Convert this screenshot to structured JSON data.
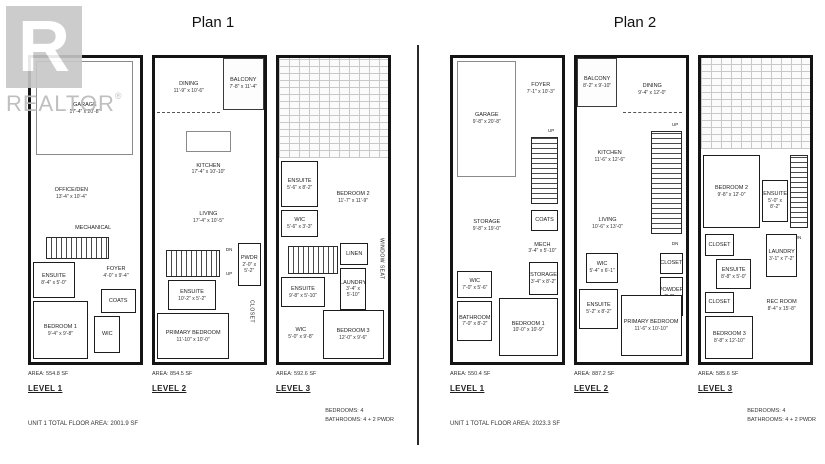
{
  "watermark": {
    "brand": "REALTOR",
    "registered": "®",
    "logo_letter": "R"
  },
  "plan1": {
    "title": "Plan 1",
    "total": "UNIT 1 TOTAL FLOOR AREA: 2001.9 SF",
    "bedrooms": "BEDROOMS: 4",
    "bathrooms": "BATHROOMS: 4 + 2 PWDR",
    "levels": [
      {
        "label": "LEVEL 1",
        "area": "AREA: 554.8 SF",
        "rooms": [
          {
            "type": "inner",
            "name": "GARAGE",
            "dims": "17'-4\" x 20'-8\"",
            "x": 5,
            "y": 1,
            "w": 89,
            "h": 31
          },
          {
            "type": "open",
            "name": "OFFICE/DEN",
            "dims": "13'-4\" x 10'-4\"",
            "x": 2,
            "y": 37,
            "w": 70,
            "h": 15
          },
          {
            "type": "open",
            "name": "MECHANICAL",
            "x": 26,
            "y": 53,
            "w": 62,
            "h": 6
          },
          {
            "type": "stairs-h",
            "x": 14,
            "y": 59,
            "w": 58,
            "h": 7
          },
          {
            "type": "open",
            "name": "FOYER",
            "dims": "4'-0\" x 9'-4\"",
            "x": 60,
            "y": 66,
            "w": 36,
            "h": 9
          },
          {
            "type": "room",
            "name": "ENSUITE",
            "dims": "8'-4\" x 5'-0\"",
            "x": 2,
            "y": 67,
            "w": 38,
            "h": 12
          },
          {
            "type": "room",
            "name": "COATS",
            "x": 64,
            "y": 76,
            "w": 32,
            "h": 8
          },
          {
            "type": "room",
            "name": "WIC",
            "x": 58,
            "y": 85,
            "w": 24,
            "h": 12
          },
          {
            "type": "room",
            "name": "BEDROOM 1",
            "dims": "9'-4\" x 9'-8\"",
            "x": 2,
            "y": 80,
            "w": 50,
            "h": 19
          }
        ]
      },
      {
        "label": "LEVEL 2",
        "area": "AREA: 854.5 SF",
        "rooms": [
          {
            "type": "balcony",
            "name": "BALCONY",
            "dims": "7'-8\" x 11'-4\"",
            "x": 62,
            "y": 0,
            "w": 38,
            "h": 17
          },
          {
            "type": "open-dash",
            "name": "DINING",
            "dims": "11'-9\" x 10'-6\"",
            "x": 2,
            "y": 2,
            "w": 58,
            "h": 16
          },
          {
            "type": "inner",
            "x": 28,
            "y": 24,
            "w": 42,
            "h": 7
          },
          {
            "type": "open",
            "name": "KITCHEN",
            "dims": "17'-4\" x 10'-10\"",
            "x": 4,
            "y": 31,
            "w": 90,
            "h": 11
          },
          {
            "type": "open",
            "name": "LIVING",
            "dims": "17'-4\" x 10'-5\"",
            "x": 4,
            "y": 45,
            "w": 90,
            "h": 15
          },
          {
            "type": "tag",
            "name": "DN",
            "x": 62,
            "y": 61,
            "w": 12,
            "h": 4
          },
          {
            "type": "stairs-h",
            "x": 10,
            "y": 63,
            "w": 50,
            "h": 9
          },
          {
            "type": "tag",
            "name": "UP",
            "x": 62,
            "y": 69,
            "w": 12,
            "h": 4
          },
          {
            "type": "room",
            "name": "PWDR",
            "dims": "2'-0\" x 5'-2\"",
            "x": 76,
            "y": 61,
            "w": 21,
            "h": 14
          },
          {
            "type": "room",
            "name": "ENSUITE",
            "dims": "10'-2\" x 5'-2\"",
            "x": 12,
            "y": 73,
            "w": 44,
            "h": 10
          },
          {
            "type": "vlabel",
            "name": "CLOSET",
            "x": 80,
            "y": 77,
            "w": 17,
            "h": 13
          },
          {
            "type": "room",
            "name": "PRIMARY BEDROOM",
            "dims": "11'-10\" x 10'-0\"",
            "x": 2,
            "y": 84,
            "w": 66,
            "h": 15
          }
        ]
      },
      {
        "label": "LEVEL 3",
        "area": "AREA: 592.6 SF",
        "rooms": [
          {
            "type": "hatch",
            "x": 0,
            "y": 0,
            "w": 100,
            "h": 33
          },
          {
            "type": "room",
            "name": "ENSUITE",
            "dims": "5'-6\" x 8'-2\"",
            "x": 2,
            "y": 34,
            "w": 34,
            "h": 15
          },
          {
            "type": "open",
            "name": "BEDROOM 2",
            "dims": "11'-7\" x 11'-9\"",
            "x": 40,
            "y": 37,
            "w": 56,
            "h": 18
          },
          {
            "type": "room",
            "name": "WIC",
            "dims": "5'-6\" x 3'-3\"",
            "x": 2,
            "y": 50,
            "w": 34,
            "h": 9
          },
          {
            "type": "stairs-h",
            "x": 8,
            "y": 62,
            "w": 46,
            "h": 9
          },
          {
            "type": "room",
            "name": "LINEN",
            "x": 56,
            "y": 61,
            "w": 26,
            "h": 7
          },
          {
            "type": "vlabel",
            "name": "WINDOW SEAT",
            "x": 89,
            "y": 52,
            "w": 10,
            "h": 28
          },
          {
            "type": "room",
            "name": "ENSUITE",
            "dims": "9'-8\" x 5'-10\"",
            "x": 2,
            "y": 72,
            "w": 40,
            "h": 10
          },
          {
            "type": "room",
            "name": "LAUNDRY",
            "dims": "3'-4\" x 5'-10\"",
            "x": 56,
            "y": 69,
            "w": 24,
            "h": 14
          },
          {
            "type": "open",
            "name": "WIC",
            "dims": "5'-0\" x 9'-8\"",
            "x": 4,
            "y": 84,
            "w": 32,
            "h": 13
          },
          {
            "type": "room",
            "name": "BEDROOM 3",
            "dims": "12'-0\" x 9'-6\"",
            "x": 40,
            "y": 83,
            "w": 56,
            "h": 16
          }
        ]
      }
    ]
  },
  "plan2": {
    "title": "Plan 2",
    "total": "UNIT 1 TOTAL FLOOR AREA: 2023.3 SF",
    "bedrooms": "BEDROOMS: 4",
    "bathrooms": "BATHROOMS: 4 + 2 PWDR",
    "levels": [
      {
        "label": "LEVEL 1",
        "area": "AREA: 550.4 SF",
        "rooms": [
          {
            "type": "inner",
            "name": "GARAGE",
            "dims": "9'-8\" x 20'-8\"",
            "x": 4,
            "y": 1,
            "w": 54,
            "h": 38
          },
          {
            "type": "open",
            "name": "FOYER",
            "dims": "7'-1\" x 10'-3\"",
            "x": 64,
            "y": 4,
            "w": 33,
            "h": 12
          },
          {
            "type": "tag",
            "name": "UP",
            "x": 84,
            "y": 22,
            "w": 12,
            "h": 4
          },
          {
            "type": "stairs-v",
            "x": 72,
            "y": 26,
            "w": 24,
            "h": 22
          },
          {
            "type": "room",
            "name": "COATS",
            "x": 72,
            "y": 50,
            "w": 24,
            "h": 7
          },
          {
            "type": "open",
            "name": "MECH",
            "dims": "3'-4\" x 5'-10\"",
            "x": 68,
            "y": 58,
            "w": 28,
            "h": 9
          },
          {
            "type": "open",
            "name": "STORAGE",
            "dims": "9'-8\" x 19'-0\"",
            "x": 4,
            "y": 48,
            "w": 54,
            "h": 14
          },
          {
            "type": "room",
            "name": "STORAGE",
            "dims": "3'-4\" x 8'-2\"",
            "x": 70,
            "y": 67,
            "w": 26,
            "h": 11
          },
          {
            "type": "room",
            "name": "WIC",
            "dims": "7'-0\" x 5'-6\"",
            "x": 4,
            "y": 70,
            "w": 32,
            "h": 9
          },
          {
            "type": "room",
            "name": "BATHROOM",
            "dims": "7'-0\" x 8'-2\"",
            "x": 4,
            "y": 80,
            "w": 32,
            "h": 13
          },
          {
            "type": "room",
            "name": "BEDROOM 1",
            "dims": "10'-0\" x 10'-9\"",
            "x": 42,
            "y": 79,
            "w": 54,
            "h": 19
          }
        ]
      },
      {
        "label": "LEVEL 2",
        "area": "AREA: 887.2 SF",
        "rooms": [
          {
            "type": "balcony",
            "name": "BALCONY",
            "dims": "8'-2\" x 9'-10\"",
            "x": 0,
            "y": 0,
            "w": 37,
            "h": 16
          },
          {
            "type": "open-dash",
            "name": "DINING",
            "dims": "9'-4\" x 12'-0\"",
            "x": 42,
            "y": 3,
            "w": 54,
            "h": 15
          },
          {
            "type": "open",
            "name": "KITCHEN",
            "dims": "11'-6\" x 12'-6\"",
            "x": 4,
            "y": 25,
            "w": 52,
            "h": 15
          },
          {
            "type": "tag",
            "name": "UP",
            "x": 84,
            "y": 20,
            "w": 12,
            "h": 4
          },
          {
            "type": "stairs-v",
            "x": 68,
            "y": 24,
            "w": 28,
            "h": 34
          },
          {
            "type": "tag",
            "name": "DN",
            "x": 84,
            "y": 59,
            "w": 12,
            "h": 4
          },
          {
            "type": "open",
            "name": "LIVING",
            "dims": "10'-6\" x 13'-0\"",
            "x": 4,
            "y": 47,
            "w": 48,
            "h": 15
          },
          {
            "type": "room",
            "name": "CLOSET",
            "x": 76,
            "y": 64,
            "w": 21,
            "h": 7
          },
          {
            "type": "room",
            "name": "POWDER",
            "dims": "2'-3\" x 7'-6\"",
            "x": 76,
            "y": 72,
            "w": 21,
            "h": 13
          },
          {
            "type": "room",
            "name": "WIC",
            "dims": "5'-4\" x 6'-1\"",
            "x": 8,
            "y": 64,
            "w": 30,
            "h": 10
          },
          {
            "type": "room",
            "name": "ENSUITE",
            "dims": "5'-2\" x 8'-2\"",
            "x": 2,
            "y": 76,
            "w": 36,
            "h": 13
          },
          {
            "type": "room",
            "name": "PRIMARY BEDROOM",
            "dims": "11'-6\" x 10'-10\"",
            "x": 40,
            "y": 78,
            "w": 56,
            "h": 20
          }
        ]
      },
      {
        "label": "LEVEL 3",
        "area": "AREA: 585.6 SF",
        "rooms": [
          {
            "type": "hatch",
            "x": 0,
            "y": 0,
            "w": 100,
            "h": 30
          },
          {
            "type": "room",
            "name": "BEDROOM 2",
            "dims": "9'-8\" x 12'-0\"",
            "x": 2,
            "y": 32,
            "w": 52,
            "h": 24
          },
          {
            "type": "room",
            "name": "ENSUITE",
            "dims": "5'-0\" x 8'-2\"",
            "x": 56,
            "y": 40,
            "w": 24,
            "h": 14
          },
          {
            "type": "stairs-v",
            "x": 82,
            "y": 32,
            "w": 16,
            "h": 24
          },
          {
            "type": "tag",
            "name": "DN",
            "x": 83,
            "y": 57,
            "w": 12,
            "h": 4
          },
          {
            "type": "room",
            "name": "CLOSET",
            "x": 4,
            "y": 58,
            "w": 26,
            "h": 7
          },
          {
            "type": "room",
            "name": "ENSUITE",
            "dims": "8'-8\" x 5'-0\"",
            "x": 14,
            "y": 66,
            "w": 32,
            "h": 10
          },
          {
            "type": "room",
            "name": "LAUNDRY",
            "dims": "3'-1\" x 7'-2\"",
            "x": 60,
            "y": 58,
            "w": 28,
            "h": 14
          },
          {
            "type": "room",
            "name": "CLOSET",
            "x": 4,
            "y": 77,
            "w": 26,
            "h": 7
          },
          {
            "type": "room",
            "name": "BEDROOM 3",
            "dims": "8'-8\" x 12'-10\"",
            "x": 4,
            "y": 85,
            "w": 44,
            "h": 14
          },
          {
            "type": "open",
            "name": "REC ROOM",
            "dims": "8'-4\" x 15'-8\"",
            "x": 52,
            "y": 73,
            "w": 44,
            "h": 17
          }
        ]
      }
    ]
  }
}
